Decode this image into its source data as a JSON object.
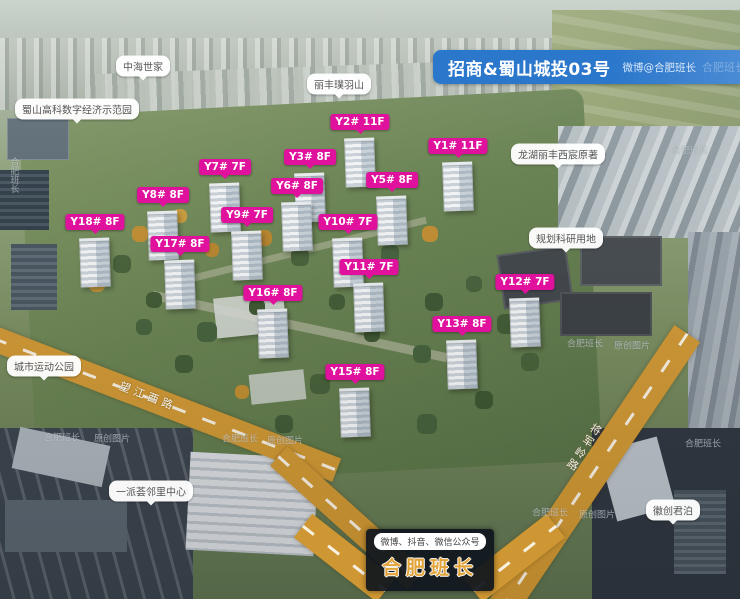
{
  "banner": {
    "title": "招商&蜀山城投03号",
    "subtitle": "微博@合肥班长",
    "watermark": "合肥班长"
  },
  "building_labels": [
    {
      "text": "Y2# 11F",
      "x": 360,
      "y": 122
    },
    {
      "text": "Y1# 11F",
      "x": 458,
      "y": 146
    },
    {
      "text": "Y3# 8F",
      "x": 310,
      "y": 157
    },
    {
      "text": "Y7# 7F",
      "x": 225,
      "y": 167
    },
    {
      "text": "Y5# 8F",
      "x": 392,
      "y": 180
    },
    {
      "text": "Y6# 8F",
      "x": 297,
      "y": 186
    },
    {
      "text": "Y8# 8F",
      "x": 163,
      "y": 195
    },
    {
      "text": "Y9# 7F",
      "x": 247,
      "y": 215
    },
    {
      "text": "Y18# 8F",
      "x": 95,
      "y": 222
    },
    {
      "text": "Y10# 7F",
      "x": 348,
      "y": 222
    },
    {
      "text": "Y17# 8F",
      "x": 180,
      "y": 244
    },
    {
      "text": "Y11# 7F",
      "x": 369,
      "y": 267
    },
    {
      "text": "Y12# 7F",
      "x": 525,
      "y": 282
    },
    {
      "text": "Y16# 8F",
      "x": 273,
      "y": 293
    },
    {
      "text": "Y13# 8F",
      "x": 462,
      "y": 324
    },
    {
      "text": "Y15# 8F",
      "x": 355,
      "y": 372
    }
  ],
  "poi_labels": [
    {
      "text": "中海世家",
      "x": 143,
      "y": 66
    },
    {
      "text": "蜀山高科数字经济示范园",
      "x": 77,
      "y": 109
    },
    {
      "text": "丽丰璞羽山",
      "x": 339,
      "y": 84
    },
    {
      "text": "龙湖丽丰西宸原著",
      "x": 558,
      "y": 154
    },
    {
      "text": "规划科研用地",
      "x": 566,
      "y": 238
    },
    {
      "text": "城市运动公园",
      "x": 44,
      "y": 366
    },
    {
      "text": "一派荟邻里中心",
      "x": 151,
      "y": 491
    },
    {
      "text": "徽创君泊",
      "x": 673,
      "y": 510
    }
  ],
  "roads": [
    {
      "name": "望江西路"
    },
    {
      "name": "将军岭路"
    }
  ],
  "footer": {
    "channels": "微博、抖音、微信公众号",
    "brand": "合肥班长"
  },
  "watermarks": [
    {
      "text": "合肥班长",
      "x": 14,
      "y": 175,
      "vertical": true
    },
    {
      "text": "合肥班长",
      "x": 690,
      "y": 150
    },
    {
      "text": "合肥班长",
      "x": 62,
      "y": 437
    },
    {
      "text": "原创图片",
      "x": 112,
      "y": 438
    },
    {
      "text": "合肥班长",
      "x": 240,
      "y": 438
    },
    {
      "text": "原创图片",
      "x": 285,
      "y": 440
    },
    {
      "text": "合肥班长",
      "x": 585,
      "y": 343
    },
    {
      "text": "原创图片",
      "x": 632,
      "y": 345
    },
    {
      "text": "合肥班长",
      "x": 550,
      "y": 512
    },
    {
      "text": "原创图片",
      "x": 597,
      "y": 514
    },
    {
      "text": "合肥班长",
      "x": 703,
      "y": 443
    }
  ]
}
